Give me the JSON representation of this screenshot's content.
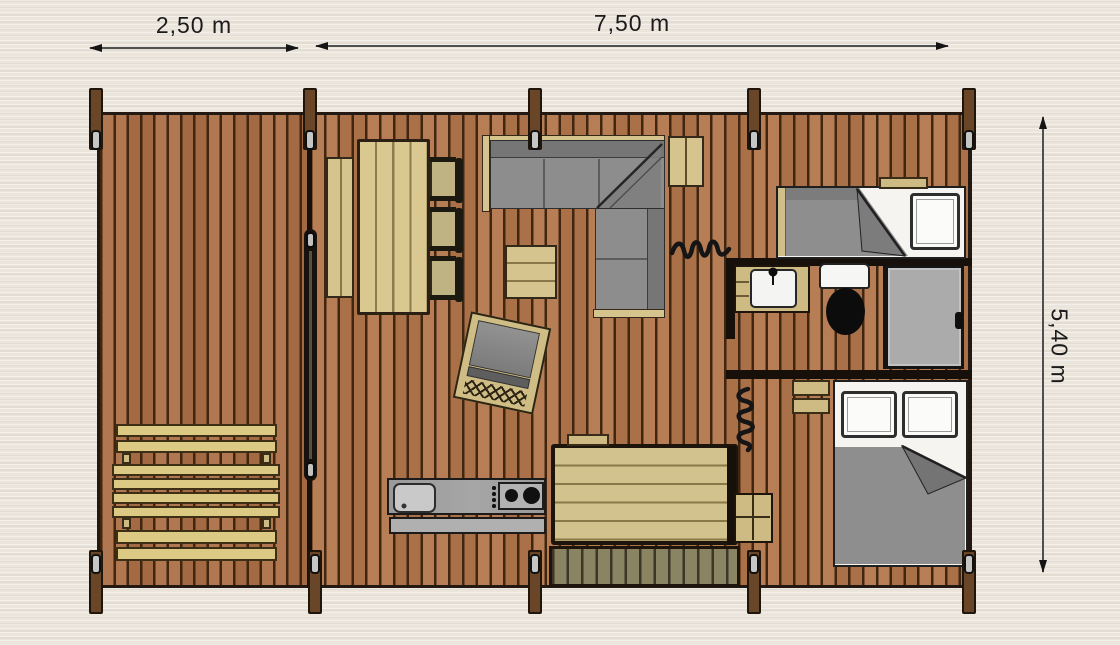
{
  "dimensions": {
    "deck_width": "2,50 m",
    "interior_width": "7,50 m",
    "depth": "5,40 m"
  },
  "palette": {
    "background": "#ebe5dc",
    "floor_plank": "#b3764c",
    "plank_gap": "#40260f",
    "furniture_wood": "#d6c48e",
    "pale_wood": "#dcc984",
    "upholstery_gray": "#8e8e8e",
    "wall_dark": "#17100a",
    "fixture_white": "#f5f4f0",
    "doormat_olive": "#8b8462"
  },
  "furniture": [
    "picnic-table",
    "sliding-door",
    "dining-bench",
    "dining-table",
    "dining-chair",
    "corner-sofa",
    "coffee-table",
    "lounge-chair",
    "kitchen-counter",
    "kitchen-sink",
    "hob",
    "large-table",
    "doormat",
    "wall-cabinet",
    "single-bed",
    "pillow",
    "wash-basin",
    "toilet",
    "shower",
    "double-bed",
    "wardrobe",
    "bedside-shelf"
  ]
}
